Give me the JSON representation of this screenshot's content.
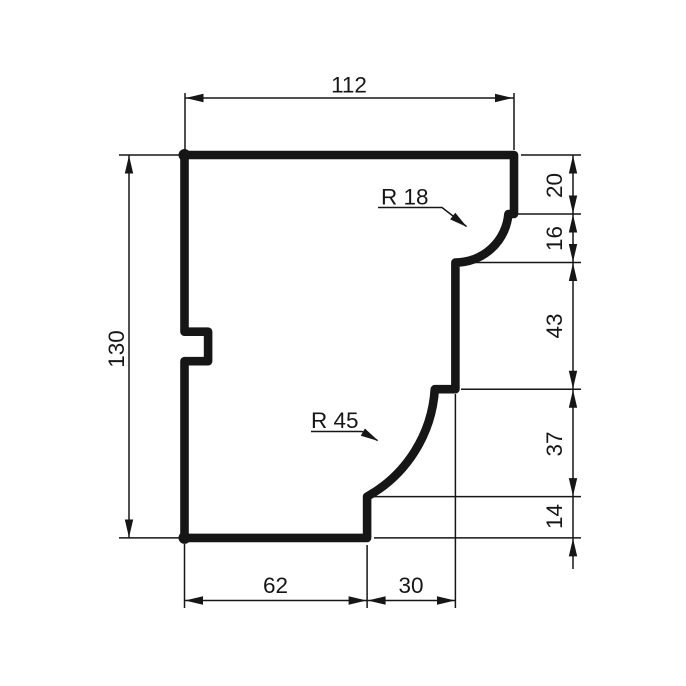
{
  "colors": {
    "ink": "#161616",
    "paper": "#ffffff"
  },
  "dims": {
    "width_top": "112",
    "height_left": "130",
    "seg_top": "20",
    "seg_upper": "16",
    "seg_mid": "43",
    "seg_lower": "37",
    "seg_bottom": "14",
    "bottom_left": "62",
    "bottom_right": "30",
    "radius_top": "R 18",
    "radius_bottom": "R 45"
  },
  "profile": {
    "type": "molding-cross-section",
    "overall_width": 112,
    "overall_height": 130,
    "right_segments_top_to_bottom": [
      20,
      16,
      43,
      37,
      14
    ],
    "bottom_segments_left_to_right": [
      62,
      30
    ],
    "cove_radius_upper": 18,
    "cove_radius_lower": 45
  }
}
